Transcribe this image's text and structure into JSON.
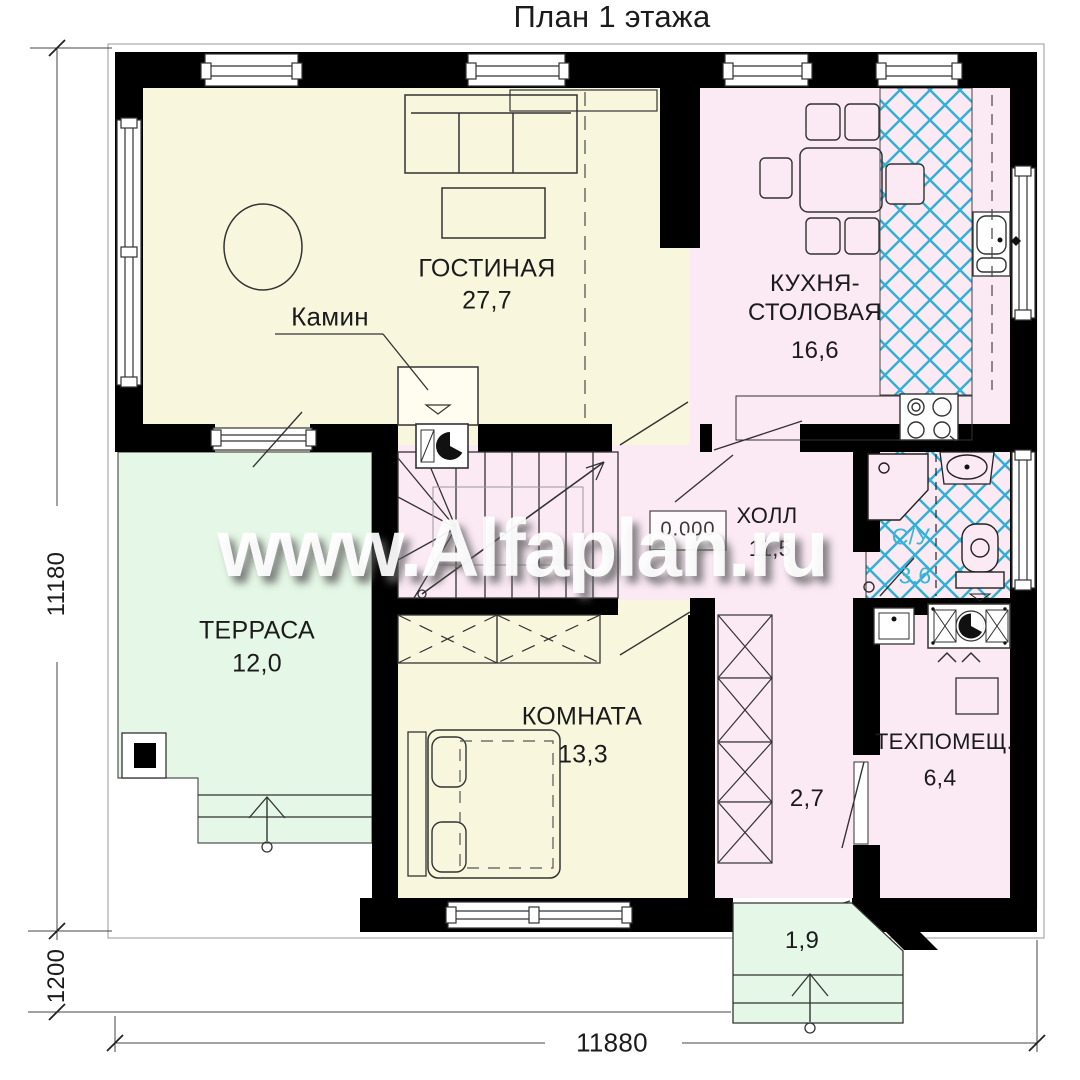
{
  "title": "План 1 этажа",
  "watermark": "www.Alfaplan.ru",
  "rooms": {
    "living": {
      "name": "ГОСТИНАЯ",
      "area": "27,7"
    },
    "kitchen": {
      "name_line1": "КУХНЯ-",
      "name_line2": "СТОЛОВАЯ",
      "area": "16,6"
    },
    "hall": {
      "name": "ХОЛЛ",
      "area": "11,5"
    },
    "bathroom": {
      "name": "С/У",
      "area": "3,6"
    },
    "terrace": {
      "name": "ТЕРРАСА",
      "area": "12,0"
    },
    "room": {
      "name": "КОМНАТА",
      "area": "13,3"
    },
    "tech": {
      "name": "ТЕХПОМЕЩ.",
      "area": "6,4"
    },
    "corridor": {
      "area": "2,7"
    },
    "porch": {
      "area": "1,9"
    }
  },
  "annotations": {
    "fireplace": "Камин",
    "level_mark": "0.000"
  },
  "dimensions": {
    "height_total": "11180",
    "porch_depth": "1200",
    "width_total": "11880"
  },
  "colors": {
    "wall": "#000000",
    "living_floor": "#f8f7de",
    "kitchen_floor": "#fbe9f4",
    "terrace_floor": "#e5f7e6",
    "tile_hatch": "#2fb0d6",
    "bath_label": "#38b7d8"
  }
}
